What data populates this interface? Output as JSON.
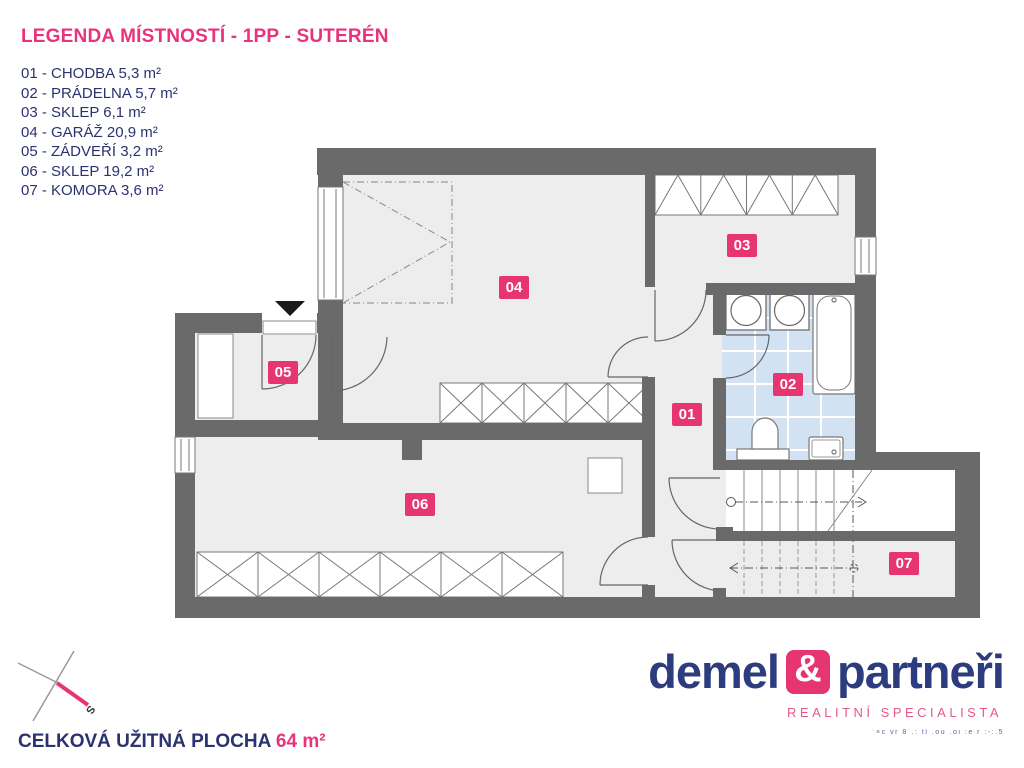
{
  "legend": {
    "title": "LEGENDA MÍSTNOSTÍ - 1PP - SUTERÉN",
    "items": [
      "01 - CHODBA 5,3 m²",
      "02 - PRÁDELNA 5,7 m²",
      "03 - SKLEP 6,1 m²",
      "04 - GARÁŽ 20,9 m²",
      "05 - ZÁDVEŘÍ 3,2 m²",
      "06 - SKLEP 19,2 m²",
      "07 - KOMORA 3,6 m²"
    ]
  },
  "rooms": [
    {
      "number": "01",
      "name": "CHODBA",
      "area": "5,3 m²"
    },
    {
      "number": "02",
      "name": "PRÁDELNA",
      "area": "5,7 m²"
    },
    {
      "number": "03",
      "name": "SKLEP",
      "area": "6,1 m²"
    },
    {
      "number": "04",
      "name": "GARÁŽ",
      "area": "20,9 m²"
    },
    {
      "number": "05",
      "name": "ZÁDVEŘÍ",
      "area": "3,2 m²"
    },
    {
      "number": "06",
      "name": "SKLEP",
      "area": "19,2 m²"
    },
    {
      "number": "07",
      "name": "KOMORA",
      "area": "3,6 m²"
    }
  ],
  "total": {
    "label": "CELKOVÁ UŽITNÁ PLOCHA",
    "value": "64 m²"
  },
  "compass": {
    "south_label": "S"
  },
  "logo": {
    "name_left": "demel",
    "ampersand": "&",
    "name_right": "partneři",
    "subtitle": "REALITNÍ SPECIALISTA",
    "fine_print": "´×c vr 8´.: tl .ou .oi :e r :-:.5"
  },
  "colors": {
    "accent_pink": "#e73571",
    "legend_pink": "#e8337c",
    "navy": "#2b3270",
    "logo_navy": "#2c3c7e",
    "wall_gray": "#6a6a6a",
    "floor_gray": "#ededed",
    "tile_blue": "#d3e2f3"
  }
}
